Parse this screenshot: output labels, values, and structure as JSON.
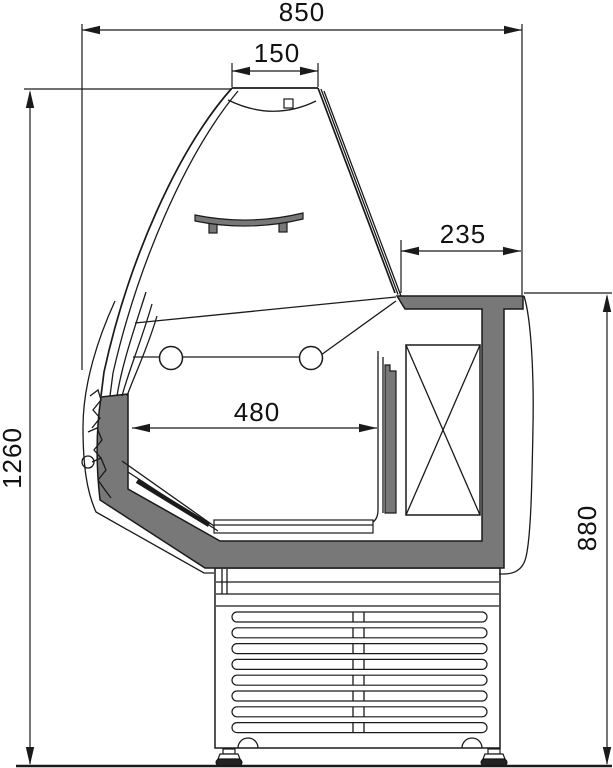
{
  "diagram": {
    "dimensions": {
      "overall_width": "850",
      "top_width": "150",
      "counter_depth": "235",
      "well_width": "480",
      "overall_height": "1260",
      "counter_height": "880"
    },
    "colors": {
      "line": "#1a1a1a",
      "panel_gray": "#787878",
      "background": "#ffffff"
    }
  }
}
